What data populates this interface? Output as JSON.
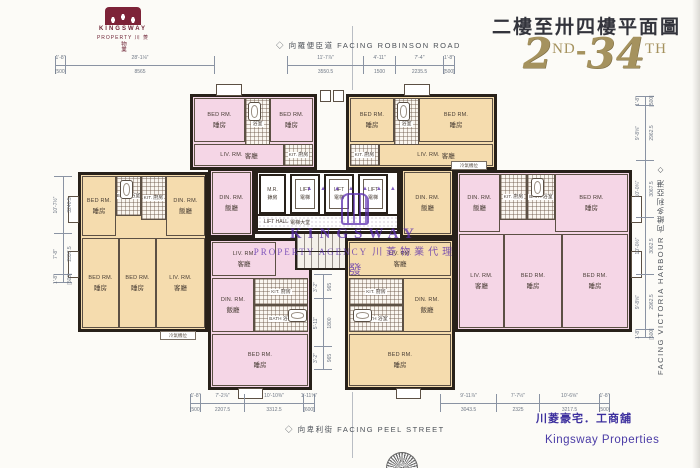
{
  "logo": {
    "line1": "KINGSWAY",
    "line2": "PROPERTY  川 菱",
    "vert": "物業"
  },
  "title": {
    "cn": "二樓至卅四樓平面圖",
    "n1": "2",
    "s1": "ND",
    "dash": "-",
    "n2": "34",
    "s2": "TH"
  },
  "facing": {
    "top": "◇ 向羅便臣道  FACING ROBINSON ROAD",
    "bottom": "◇ 向卑利街  FACING PEEL STREET",
    "right": "FACING VICTORIA HARBOUR  向維多利亞港 ◇"
  },
  "labels": {
    "bed_en": "BED RM.",
    "bed_cn": "睡房",
    "liv_en": "LIV. RM.",
    "liv_cn": "客廳",
    "din_en": "DIN. RM.",
    "din_cn": "飯廳",
    "kit_en": "KIT.",
    "kit_cn": "廚房",
    "bath_en": "BATH",
    "bath_cn": "浴室",
    "ac": "冷氣機位"
  },
  "core": {
    "mr_en": "M.R.",
    "mr_cn": "錶房",
    "lift_en": "LIFT",
    "lift_cn": "電梯",
    "hall_en": "LIFT HALL",
    "hall_cn": "電梯大堂"
  },
  "stamp": {
    "arc": "▲▲▲▲▲▲▲",
    "line1": "KINGSWAY",
    "line2": "PROPERTY AGENCY",
    "cjk": "川菱物業代理",
    "char": "發"
  },
  "footer": {
    "tagline": "川菱豪宅．工商舖",
    "company": "Kingsway Properties"
  },
  "dims": {
    "top_left": [
      {
        "ft": "1'-8\"",
        "mm": "[500]"
      },
      {
        "ft": "28'-1⅛\"",
        "mm": "8565"
      }
    ],
    "top_center": [
      {
        "ft": "11'-7⅞\"",
        "mm": "3550.5"
      },
      {
        "ft": "4'-11\"",
        "mm": "1500"
      },
      {
        "ft": "7'-4\"",
        "mm": "2235.5"
      },
      {
        "ft": "1'-8\"",
        "mm": "[500]"
      }
    ],
    "bottom_left": [
      {
        "ft": "1'-8\"",
        "mm": "[500]"
      },
      {
        "ft": "7'-2⅞\"",
        "mm": "2207.5"
      },
      {
        "ft": "10'-10⅜\"",
        "mm": "3312.5"
      },
      {
        "ft": "1'-11⅝\"",
        "mm": "[600]"
      }
    ],
    "bottom_right": [
      {
        "ft": "9'-11⅞\"",
        "mm": "3043.5"
      },
      {
        "ft": "7'-7½\"",
        "mm": "2325"
      },
      {
        "ft": "10'-6⅝\"",
        "mm": "3217.5"
      },
      {
        "ft": "1'-8\"",
        "mm": "[500]"
      }
    ],
    "left": [
      {
        "ft": "10'-7½\"",
        "mm": "3240.5"
      },
      {
        "ft": "7'-8\"",
        "mm": "2337.5"
      },
      {
        "ft": "1'-8\"",
        "mm": "[500]"
      }
    ],
    "right": [
      {
        "ft": "1'-8\"",
        "mm": "[500]"
      },
      {
        "ft": "9'-8⅝\"",
        "mm": "2962.5"
      },
      {
        "ft": "10'-0¾\"",
        "mm": "3067.5"
      },
      {
        "ft": "10'-0½\"",
        "mm": "3062.5"
      },
      {
        "ft": "9'-8⅝\"",
        "mm": "2962.5"
      },
      {
        "ft": "1'-8\"",
        "mm": "[500]"
      }
    ],
    "inner": [
      {
        "ft": "3'-2\"",
        "mm": "965"
      },
      {
        "ft": "5'-11\"",
        "mm": "1800"
      },
      {
        "ft": "3'-2\"",
        "mm": "965"
      }
    ]
  }
}
